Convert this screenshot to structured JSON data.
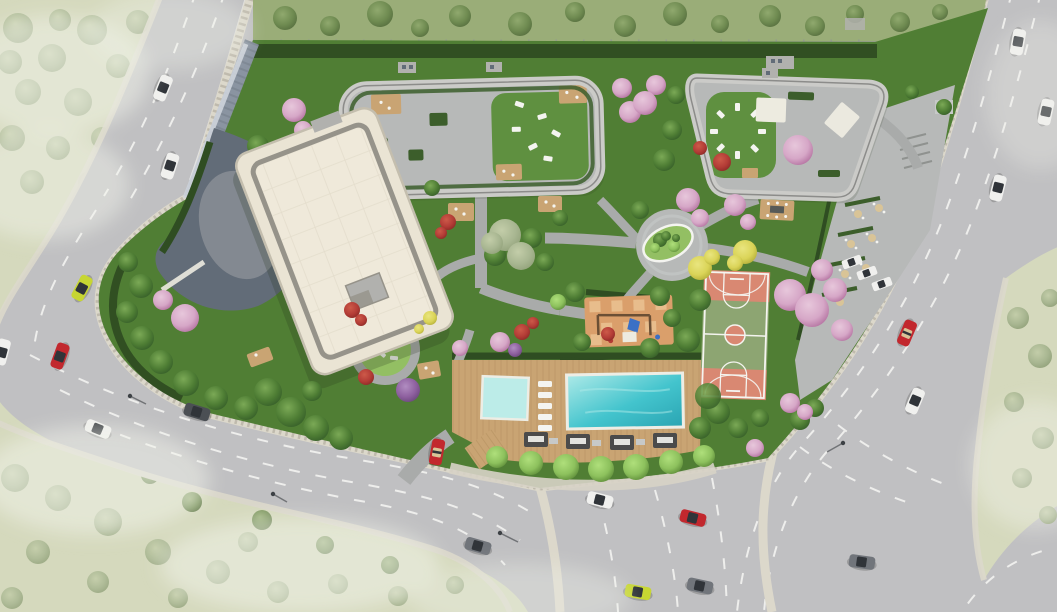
{
  "scene": {
    "type": "3d-architectural-aerial-render",
    "description": "Top-down render of a residential complex: cream flat-roof tower, two landscaped rooftop terraces, central gardens with paths, swimming pool with wood deck and cabanas, basketball court, playground and outdoor cafe plaza, surrounded by curving multi-lane roads with cars and hazy green fields at the corners."
  },
  "inventory": {
    "buildings": [
      "main-residential-building",
      "rooftop-terrace-west",
      "rooftop-terrace-east",
      "entrance-canopy",
      "retaining-wall"
    ],
    "amenities": [
      "swimming-pool",
      "kids-pool",
      "pool-deck",
      "sun-loungers",
      "cabanas",
      "basketball-court",
      "playground",
      "central-plaza",
      "outdoor-cafe",
      "garden-paths",
      "lawn-gardens",
      "boundary-hedge",
      "wood-decks"
    ],
    "vehicle_colors": [
      "white",
      "red",
      "lime-green",
      "gray",
      "dark-gray"
    ],
    "vehicle_count": 19,
    "parked_vehicle_count": 3,
    "tree_types": [
      "green",
      "pink-blossom",
      "red-shrub",
      "yellow",
      "purple",
      "poolside-ball",
      "faded-field"
    ]
  },
  "palette": {
    "field_pale": "#d5d9bd",
    "field_tree_hi": "#c3cda9",
    "field_tree": "#a8b691",
    "field_tree_lo": "#8c9c74",
    "field_upper": "#9aad78",
    "upper_tree_hi": "#90a96e",
    "upper_tree": "#6f8b51",
    "upper_tree_lo": "#50673a",
    "haze_white": "#f2f3ec",
    "road": "#c0c0c2",
    "road_shoulder": "#adadaf",
    "lane_white": "#f3f3f1",
    "curb_stone": "#dcd8cb",
    "curb_dot": "#a8a295",
    "gravel": "#d7d3c6",
    "site_grass": "#507e34",
    "lawn": "#5f9040",
    "lawn_light": "#93bf63",
    "hedge": "#2f4d22",
    "hedge_bright": "#3c5e2b",
    "path_gray": "#a9abaa",
    "paving": "#b7b9b8",
    "paving_light": "#c7c9c8",
    "terrace_border": "#cbcbc8",
    "terrace_line": "#8c8c8a",
    "building_roof": "#eae4d4",
    "building_roof_light": "#efe9da",
    "building_band": "#96938a",
    "building_edge": "#c4beae",
    "building_gray": "#b1b1ae",
    "roof_grid": "#ddd6c5",
    "wall_slate": "#8a94a1",
    "wall_light": "#ced4db",
    "canopy_slate": "#626c78",
    "deck_wood": "#c9a473",
    "deck_line": "#b18d5d",
    "pool_hi": "#aeeae8",
    "pool_main": "#43c4cd",
    "pool_lo": "#2aa4b2",
    "pool_kids": "#bcece8",
    "pool_edge": "#edede5",
    "cabana": "#4b4b4b",
    "lounger": "#f4f4f0",
    "umbrella_tan": "#d9c497",
    "pavilion_white": "#edebe0",
    "court_green": "#8da572",
    "court_salmon": "#d98872",
    "court_line": "#f4f4ef",
    "playground_orange": "#da9f6b",
    "playground_check": "#eac190",
    "playground_blue": "#3b70c5",
    "playground_post": "#6b4f35",
    "tree_green_hi": "#7ba956",
    "tree_green": "#4e7d34",
    "tree_green_lo": "#2f5526",
    "ball_hi": "#afdf7b",
    "ball": "#8dc15d",
    "ball_lo": "#507d2f",
    "blossom_hi": "#e7c7db",
    "blossom": "#d6a7c7",
    "blossom_lo": "#a86093",
    "red_hi": "#cd5a49",
    "red": "#b33c36",
    "red_lo": "#7f2521",
    "yellow_hi": "#e9e57f",
    "yellow": "#dad458",
    "yellow_lo": "#a9a32f",
    "purple_hi": "#b18dc1",
    "purple": "#8e609f",
    "purple_lo": "#604071",
    "car_white": "#f0f0ee",
    "car_red": "#c2282e",
    "car_lime": "#c7d632",
    "car_gray": "#71757b",
    "car_dark": "#4b4f54",
    "car_glass": "#303439",
    "lamp_dark": "#3d4145",
    "stair_gray": "#8f928f",
    "fence_gray": "#909692",
    "table_dark": "#565a58",
    "shadow": "#26331d"
  }
}
